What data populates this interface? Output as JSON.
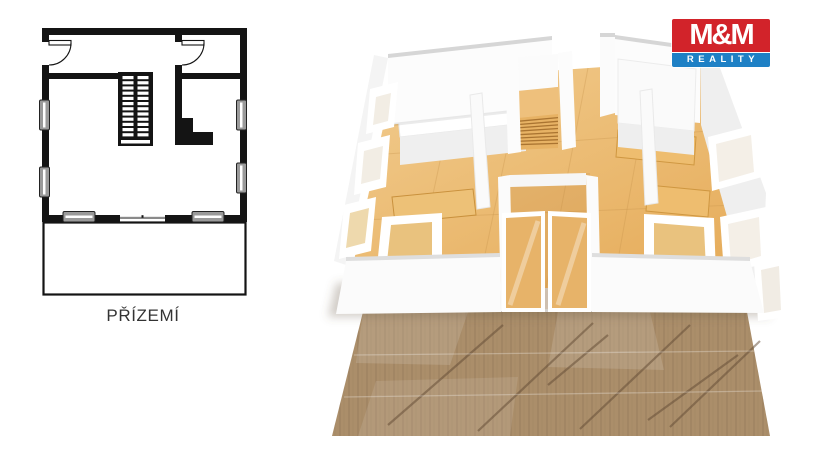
{
  "floor_plan_2d": {
    "label": "PŘÍZEMÍ"
  },
  "floor_plan_3d": {
    "description": "3d-rendered-ground-floor-model"
  },
  "logo": {
    "title": "M&M",
    "subtitle": "REALITY",
    "red": "#d2232a",
    "blue": "#1e80c5"
  },
  "palette": {
    "plan_ink": "#141414",
    "interior_floor_wood": "#eec07d",
    "deck_wood": "#ab8e6a",
    "wall_white": "#fafafa",
    "background": "#ffffff"
  }
}
